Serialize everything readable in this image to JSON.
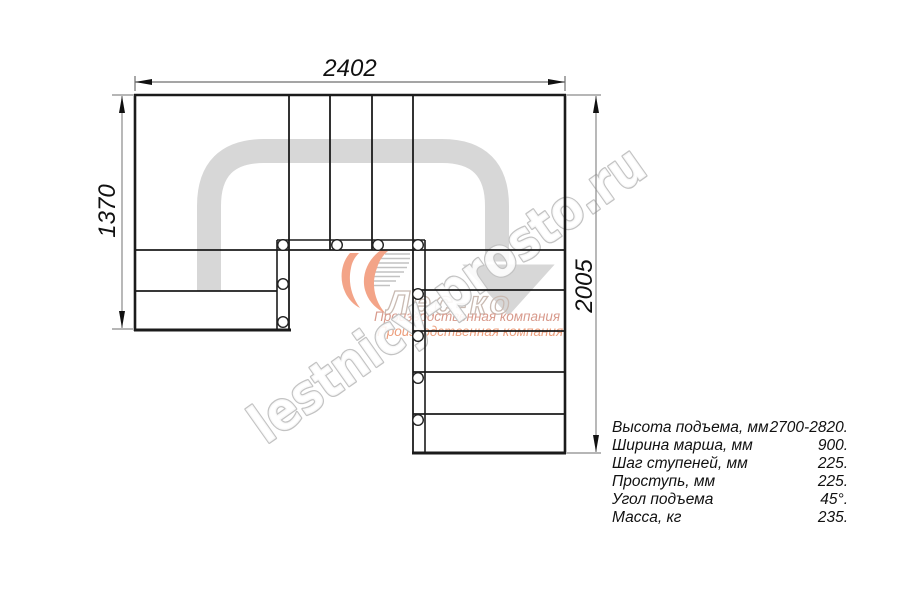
{
  "dimensions": {
    "width_top": "2402",
    "height_left": "1370",
    "height_right": "2005"
  },
  "specs": {
    "rows": [
      {
        "label": "Высота подъема, мм",
        "value": "2700-2820."
      },
      {
        "label": "Ширина марша, мм",
        "value": "900."
      },
      {
        "label": "Шаг ступеней, мм",
        "value": "225."
      },
      {
        "label": "Проступь, мм",
        "value": "225."
      },
      {
        "label": "Угол подъема",
        "value": "45°."
      },
      {
        "label": "Масса, кг",
        "value": "235."
      }
    ]
  },
  "watermark": {
    "site_text": "lestnicy-prosto.ru",
    "logo_text": "Лес-ко",
    "company_line1": "Производственная компания",
    "company_line2": "Производственная компания"
  },
  "colors": {
    "line": "#1b1b1b",
    "dim_line": "#6f6f6f",
    "arrow_gray": "#d7d7d7",
    "watermark_gray": "#c3c3c3",
    "logo_orange": "#f3a488"
  }
}
